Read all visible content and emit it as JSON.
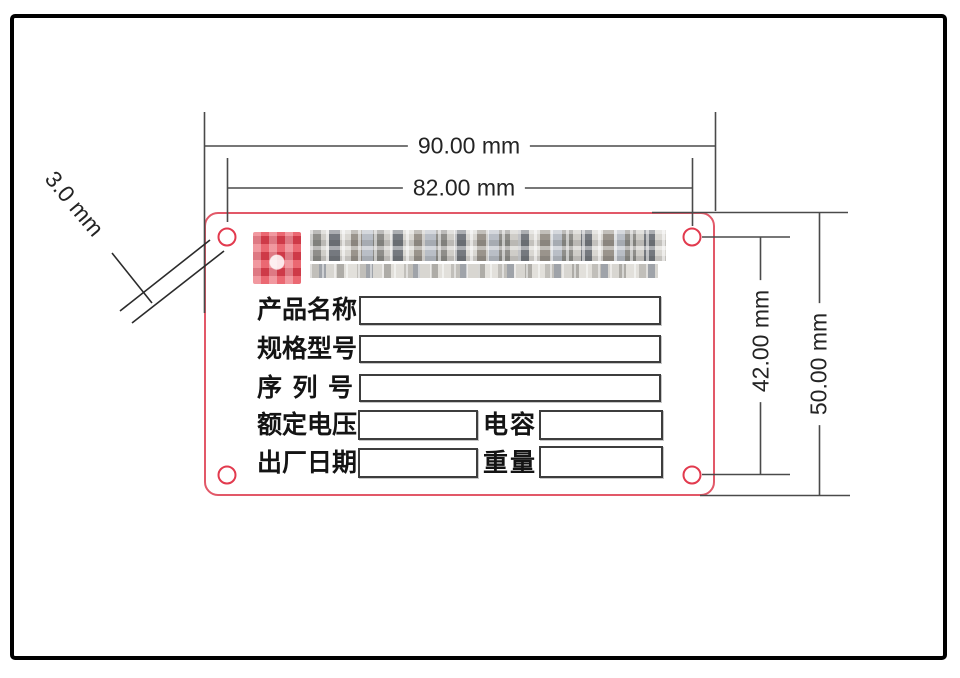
{
  "dimensions": {
    "outer_width": "90.00 mm",
    "hole_span_width": "82.00 mm",
    "hole_span_height": "42.00 mm",
    "outer_height": "50.00 mm",
    "hole_diameter": "3.0 mm"
  },
  "plate": {
    "redactions": {
      "logo": "pixelated red company seal",
      "company_name": "pixelated"
    },
    "fields": [
      {
        "label": "产品名称",
        "value": ""
      },
      {
        "label": "规格型号",
        "value": ""
      },
      {
        "label": "序列号",
        "value": ""
      },
      {
        "label": "额定电压",
        "value": "",
        "label2": "电容",
        "value2": ""
      },
      {
        "label": "出厂日期",
        "value": "",
        "label2": "重量",
        "value2": ""
      }
    ]
  },
  "colors": {
    "plate_border": "#e25868",
    "hole_ring": "#e23a4e",
    "logo_red": "#da4351",
    "dimension_line": "#4a4a4a",
    "dimension_text": "#242424",
    "box_border": "#3d3d3d",
    "sheet_frame": "#000000"
  }
}
